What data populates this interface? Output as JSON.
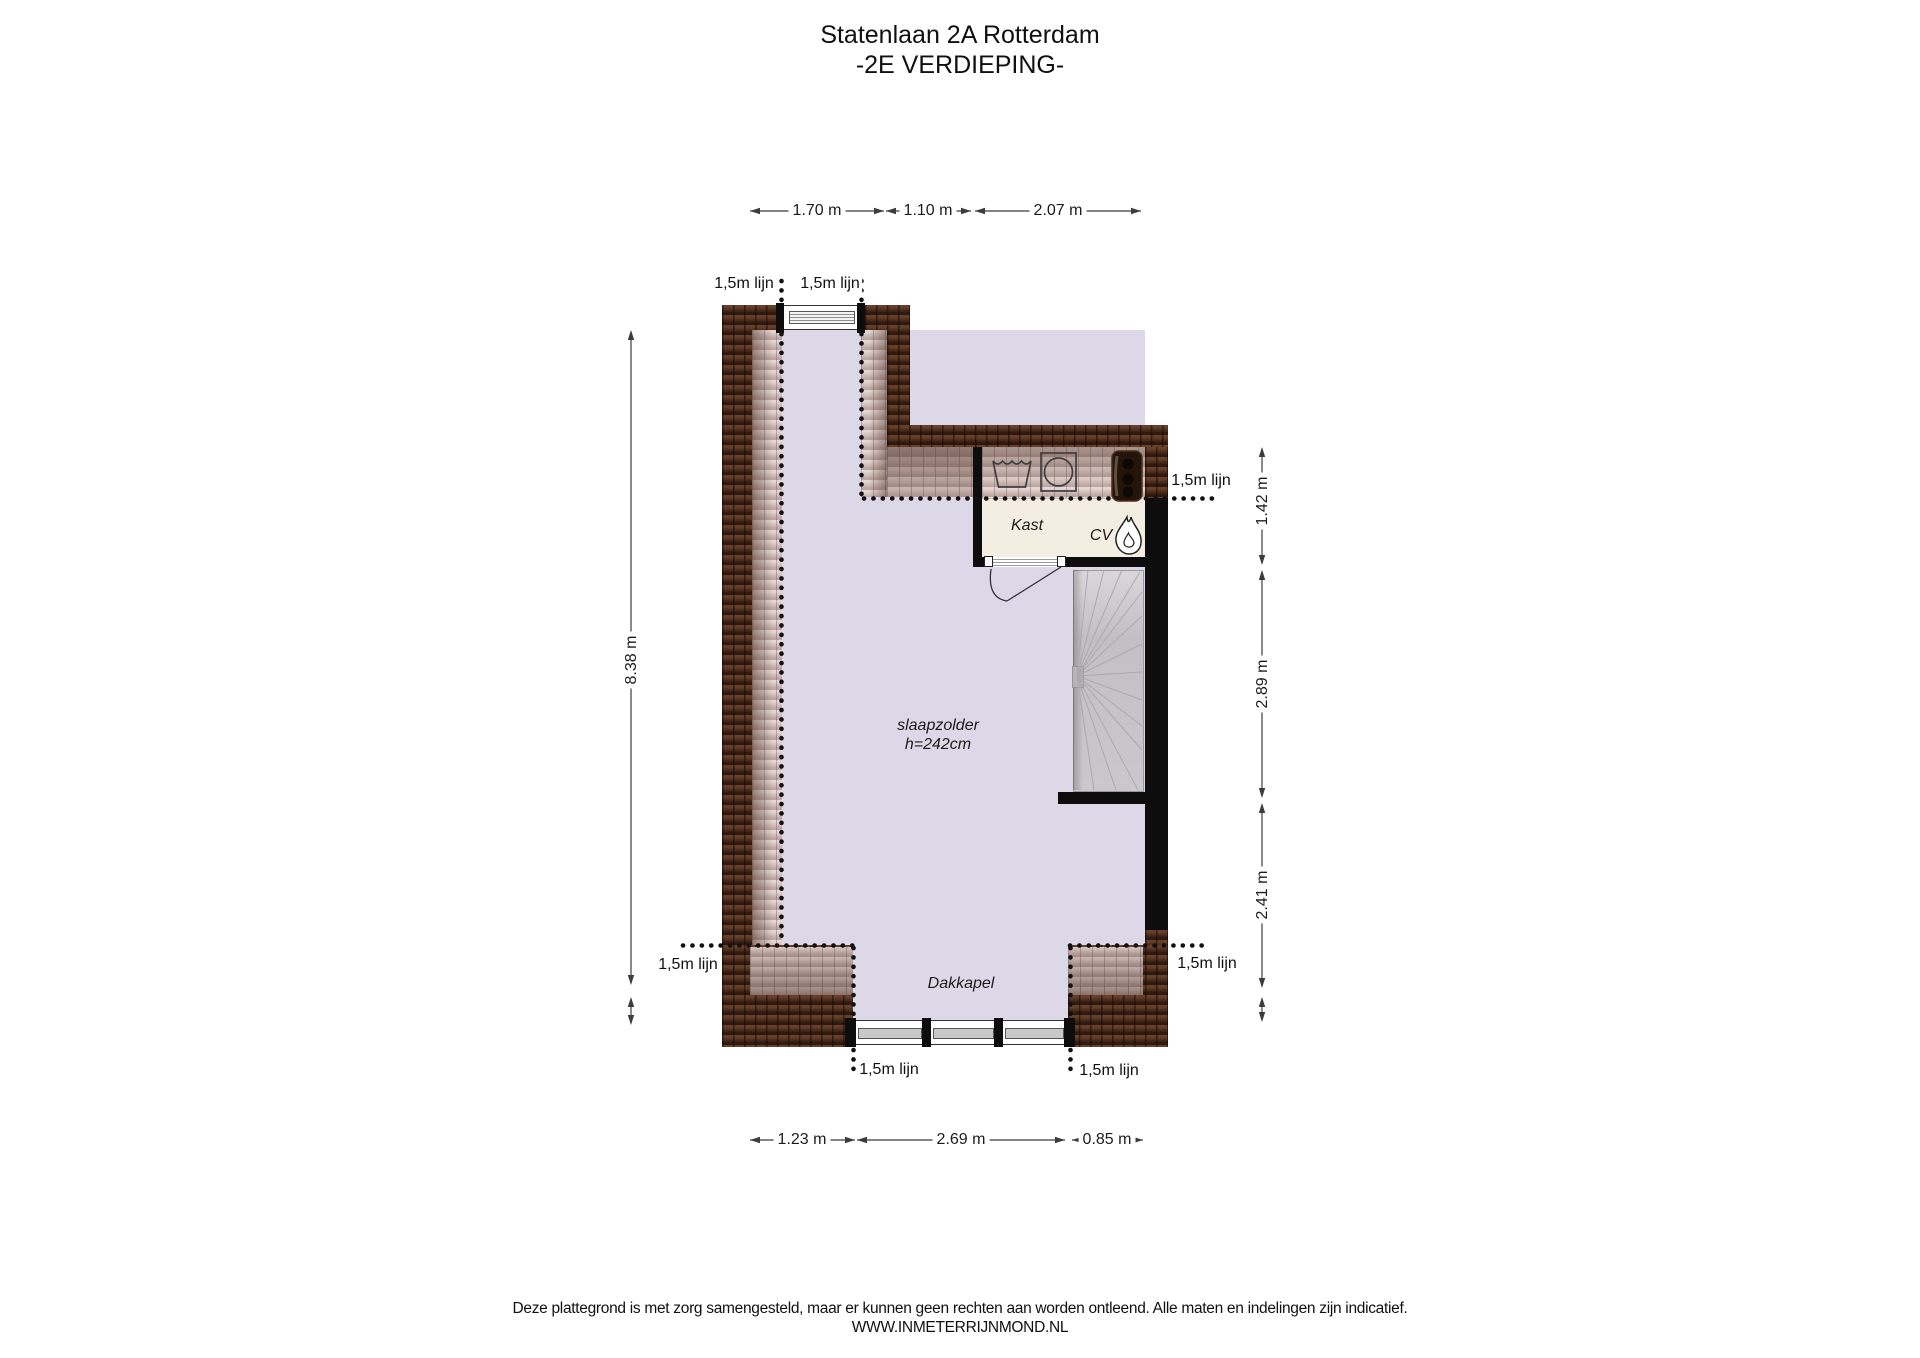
{
  "title": {
    "line1": "Statenlaan 2A Rotterdam",
    "line2": "-2E VERDIEPING-"
  },
  "labels": {
    "room": "slaapzolder",
    "room_height": "h=242cm",
    "closet": "Kast",
    "cv": "CV",
    "dormer": "Dakkapel",
    "line15": "1,5m lijn"
  },
  "dimensions": {
    "top": [
      "1.70 m",
      "1.10 m",
      "2.07 m"
    ],
    "left": [
      "8.38 m"
    ],
    "right": [
      "1.42 m",
      "2.89 m",
      "2.41 m"
    ],
    "bottom": [
      "1.23 m",
      "2.69 m",
      "0.85 m"
    ]
  },
  "footer": {
    "disclaimer": "Deze plattegrond is met zorg samengesteld, maar er kunnen geen rechten aan worden ontleend. Alle maten en indelingen zijn indicatief.",
    "website": "WWW.INMETERRIJNMOND.NL"
  },
  "colors": {
    "wall_tile_brown": "#402516",
    "wall_black": "#0d0d0d",
    "roof_slope_pink": "#d9c3bf",
    "floor_lavender": "#dcd8e7",
    "closet_cream": "#f3eee1",
    "stair_grey": "#c7c5c9"
  }
}
